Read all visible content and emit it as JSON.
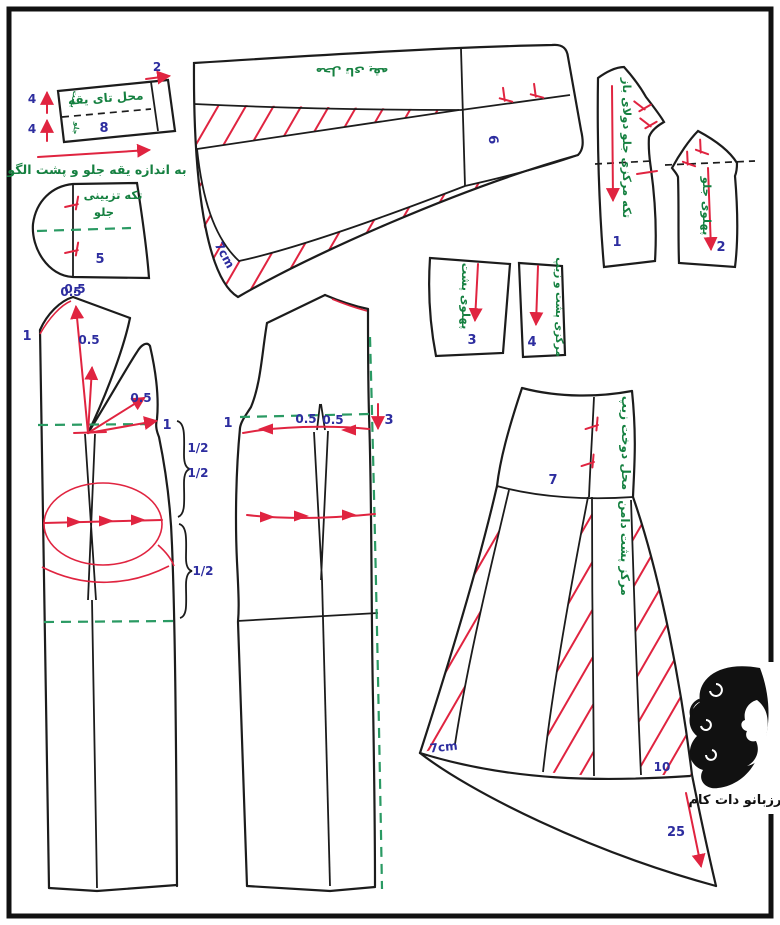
{
  "colors": {
    "outline": "#1c1c1c",
    "red": "#e02440",
    "green_text": "#158040",
    "green_dash": "#2a9a63",
    "blue_number": "#2d2d9f"
  },
  "collar_band": {
    "fold_label": "محل تای یقه",
    "back": "پشت",
    "front": "جلو",
    "num": "8",
    "left_top": "4",
    "left_bottom": "4",
    "top": "2"
  },
  "note": {
    "text": "به اندازه یقه جلو و پشت الگو"
  },
  "piece5": {
    "label_line1": "تکه تزیینی",
    "label_line2": "جلو",
    "num": "5",
    "offset": "0.5"
  },
  "collar": {
    "fold_label": "محل تای یقه",
    "num": "6",
    "width": "7cm"
  },
  "piece1": {
    "label": "تکه مرکزی جلو دولای باز",
    "num": "1"
  },
  "piece2": {
    "label": "پهلوی جلو",
    "num": "2"
  },
  "piece3": {
    "label": "پهلوی پشت",
    "num": "3"
  },
  "piece4": {
    "label": "مرکزی پشت و زیپ",
    "num": "4"
  },
  "front": {
    "neck_offset": "0.5",
    "left": "1",
    "v_offset": "0.5",
    "panel_offset": "0.5",
    "side": "1",
    "half_a": "1/2",
    "half_b": "1/2",
    "half_c": "1/2"
  },
  "back": {
    "left": "1",
    "offset_a": "0.5",
    "offset_b": "0.5",
    "right": "3"
  },
  "skirt": {
    "num": "7",
    "zip_label": "محل دوخت زیپ",
    "center_label": "مرکز پشت دامن",
    "hem_width": "7cm",
    "right_num": "10",
    "flare_num": "25"
  },
  "logo": {
    "text": "رزبانو دات کام"
  }
}
